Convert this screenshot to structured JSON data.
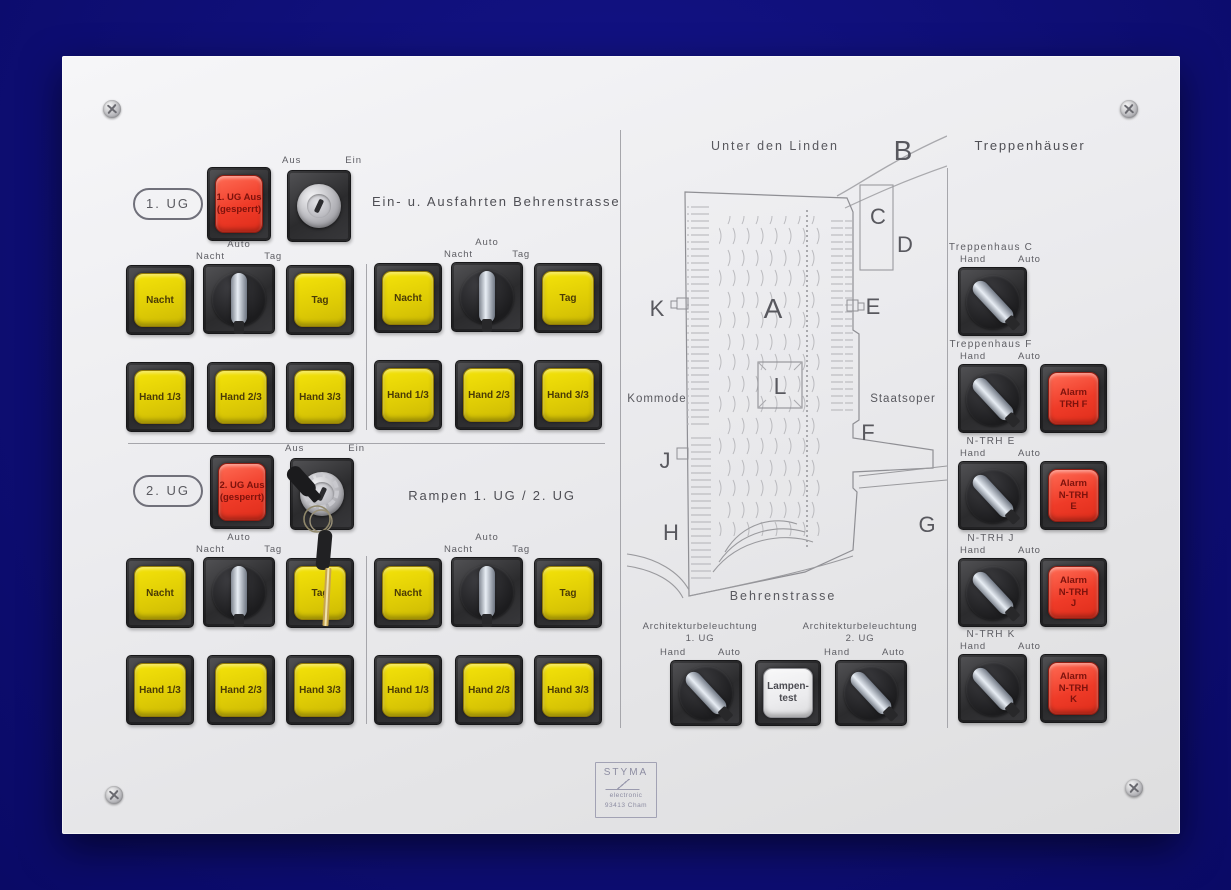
{
  "colors": {
    "background": "#0e0e74",
    "panel": "#ececef",
    "button_yellow": "#e6cf07",
    "button_red": "#ee3b28",
    "alarm_red": "#ef4530",
    "cap_white": "#f2f2f4"
  },
  "ug1": {
    "badge": "1. UG",
    "lock_line1": "1. UG Aus",
    "lock_line2": "(gesperrt)",
    "heading": "Ein- u. Ausfahrten Behrenstrasse"
  },
  "ug2": {
    "badge": "2. UG",
    "lock_line1": "2. UG Aus",
    "lock_line2": "(gesperrt)",
    "heading": "Rampen 1. UG / 2. UG"
  },
  "keyswitch": {
    "off": "Aus",
    "on": "Ein"
  },
  "selector": {
    "auto": "Auto",
    "night": "Nacht",
    "day": "Tag"
  },
  "mode": {
    "hand": "Hand",
    "auto": "Auto"
  },
  "buttons": {
    "night": "Nacht",
    "day": "Tag",
    "hand1": "Hand 1/3",
    "hand2": "Hand 2/3",
    "hand3": "Hand 3/3"
  },
  "lamp_test": {
    "line1": "Lampen-",
    "line2": "test"
  },
  "arch": {
    "title": "Architekturbeleuchtung",
    "sub1": "1. UG",
    "sub2": "2. UG"
  },
  "trh": {
    "heading": "Treppenhäuser",
    "items": [
      {
        "label": "Treppenhaus C"
      },
      {
        "label": "Treppenhaus F",
        "alarm": [
          "Alarm",
          "TRH F"
        ]
      },
      {
        "label": "N-TRH E",
        "alarm": [
          "Alarm",
          "N-TRH",
          "E"
        ]
      },
      {
        "label": "N-TRH J",
        "alarm": [
          "Alarm",
          "N-TRH",
          "J"
        ]
      },
      {
        "label": "N-TRH K",
        "alarm": [
          "Alarm",
          "N-TRH",
          "K"
        ]
      }
    ]
  },
  "map": {
    "street_top": "Unter den Linden",
    "street_bottom": "Behrenstrasse",
    "landmark_left": "Kommode",
    "landmark_right": "Staatsoper",
    "markers": {
      "a": "A",
      "b": "B",
      "c": "C",
      "d": "D",
      "e": "E",
      "f": "F",
      "g": "G",
      "h": "H",
      "j": "J",
      "k": "K",
      "l": "L"
    }
  },
  "logo": {
    "name": "STYMA",
    "line2": "electronic",
    "line3": "93413 Cham"
  }
}
